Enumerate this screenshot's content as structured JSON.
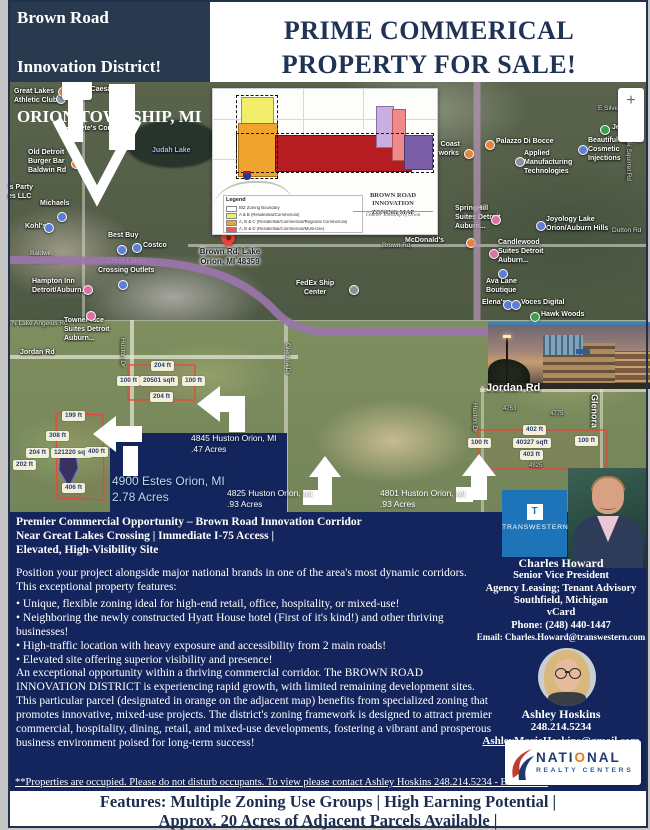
{
  "colors": {
    "header_navy": "#293a4e",
    "panel_navy": "#13255c",
    "title_navy": "#203354",
    "light_blue_text": "#badbf7",
    "transwestern_blue": "#1e74b8",
    "nrc_navy": "#1d3a6d",
    "nrc_orange": "#e87722",
    "nrc_blue": "#2f5f9e",
    "legend_yellow": "#f2ee6a",
    "legend_orange": "#f0a32e",
    "legend_red": "#b51d22",
    "parcel_outline_red": "#e8463a"
  },
  "header": {
    "line1": "Brown Road",
    "line2": "Innovation District!",
    "line3": "ORION TOWNSHIP, MI",
    "sale": "PRIME COMMERICAL\nPROPERTY FOR SALE!"
  },
  "map": {
    "zoom_in": "+",
    "zoom_out": "−",
    "pois": {
      "glac": "Great Lakes\nAthletic Club",
      "little_caesars": "Little Caesars",
      "petes": "Pete's Coney",
      "old_detroit": "Old Detroit\nBurger Bar\nBaldwin Rd",
      "judah": "Judah Lake",
      "party": "'s Party\nes LLC",
      "michaels": "Michaels",
      "kohls": "Kohl's",
      "commons": "Baldwin\nCommons",
      "glco": "Great Lakes\nCrossing Outlets",
      "best_buy": "Best Buy",
      "costco": "Costco",
      "hampton": "Hampton Inn\nDetroit/Auburn...",
      "brown_pin": "Brown Rd, Lake\nOrion, MI 48359",
      "brown_rd": "Brown Rd",
      "fedex": "FedEx Ship\nCenter",
      "mcdonalds": "McDonald's",
      "palazzo": "Palazzo Di Bocce",
      "north_coast": "th Coast\nerworks",
      "applied": "Applied\nManufacturing\nTechnologies",
      "jesse": "Jesse De",
      "beautiful": "Beautiful You\nCosmetic\nInjections",
      "silverbell": "E Silverbell Rd",
      "springhill": "SpringHill\nSuites Detroit\nAuburn...",
      "joyology": "Joyology Lake\nOrion/Auburn Hills",
      "candlewood": "Candlewood\nSuites Detroit\nAuburn...",
      "ava": "Ava Lane\nBoutique",
      "elenas": "Elena's",
      "voces": "Voces Digital",
      "hawk": "Hawk Woods",
      "squirrel": "N Squirrel Rd",
      "dutton": "Dutton Rd",
      "lake_angelus": "N Lake Angelus Rd",
      "towneplace": "TownePlace\nSuites Detroit\nAuburn...",
      "jordan1": "Jordan Rd",
      "jordan2": "Jordan Rd",
      "huston1": "Huston Dr",
      "glenora1": "Glenora Dr",
      "huston2": "Huston Dr",
      "glenora2": "Glenora",
      "hn1": "4763",
      "hn2": "4775",
      "hn3": "4825"
    }
  },
  "zoning": {
    "legend_title": "Legend",
    "legend": [
      "BIZ Zoning Boundary",
      "A & B (Residential/Commercial)",
      "A, B & C (Residential/Commercial/Regional Commercial)",
      "A, B & D (Residential/Commercial/Multi-Use)"
    ],
    "title": "BROWN ROAD INNOVATION\nZONING MAP",
    "subtitle": "Charter Township of Orion"
  },
  "parcels": {
    "a4900": "4900 Estes Orion, MI\n2.78 Acres",
    "a4845": "4845 Huston Orion, MI\n.47 Acres",
    "a4825": "4825 Huston Orion, MI\n.93 Acres",
    "a4801": "4801 Huston Orion, MI\n.93 Acres",
    "estes_chips": [
      "199 ft",
      "308 ft",
      "204 ft",
      "121220 sqft",
      "400 ft",
      "202 ft",
      "406 ft"
    ],
    "c4845": [
      "204 ft",
      "100 ft",
      "20501 sqft",
      "100 ft",
      "204 ft"
    ],
    "c4801": [
      "402 ft",
      "100 ft",
      "40327 sqft",
      "100 ft",
      "403 ft"
    ]
  },
  "body": {
    "headline": "Premier Commercial Opportunity – Brown Road Innovation Corridor\nNear Great Lakes Crossing | Immediate I-75 Access |\nElevated, High-Visibility Site",
    "intro": "Position your project alongside major national brands in one of the area's most dynamic corridors.\nThis exceptional property features:",
    "bullets": [
      "• Unique, flexible zoning ideal for high-end retail, office, hospitality, or mixed-use!",
      "• Neighboring the newly constructed Hyatt House hotel (First of it's kind!) and other thriving businesses!",
      "• High-traffic location with heavy exposure and accessibility from 2 main roads!",
      "• Elevated site offering superior visibility and presence!"
    ],
    "para2": "An exceptional opportunity within a thriving commercial corridor. The BROWN ROAD INNOVATION DISTRICT is experiencing rapid growth, with limited remaining development sites. This particular parcel (designated in orange on the adjacent map) benefits from specialized zoning that promotes innovative, mixed-use projects. The district's zoning framework is designed to attract premier commercial, hospitality, dining, retail, and mixed-use developments, fostering a vibrant and prosperous business environment poised for long-term success!"
  },
  "contacts": {
    "transwestern": {
      "icon": "T",
      "name": "TRANSWESTERN"
    },
    "charles": {
      "name": "Charles Howard",
      "title": "Senior Vice President",
      "dept": "Agency Leasing; Tenant Advisory",
      "city": "Southfield, Michigan",
      "vcard": "vCard",
      "phone": "Phone: (248) 440-1447",
      "email": "Email: Charles.Howard@transwestern.com"
    },
    "ashley": {
      "name": "Ashley Hoskins",
      "phone": "248.214.5234",
      "email": "AshleyMarieHoskins@gmail.com"
    },
    "nrc": {
      "parts": [
        "NATI",
        "O",
        "NAL"
      ],
      "tagline": "REALTY CENTERS"
    }
  },
  "footer": {
    "notice": "**Properties are occupied. Please do not disturb occupants. To view please contact Ashley Hoskins 248.214.5234 - BATVAI**",
    "features": "Features: Multiple Zoning Use Groups | High Earning Potential |\nApprox. 20 Acres of Adjacent Parcels Available |"
  }
}
